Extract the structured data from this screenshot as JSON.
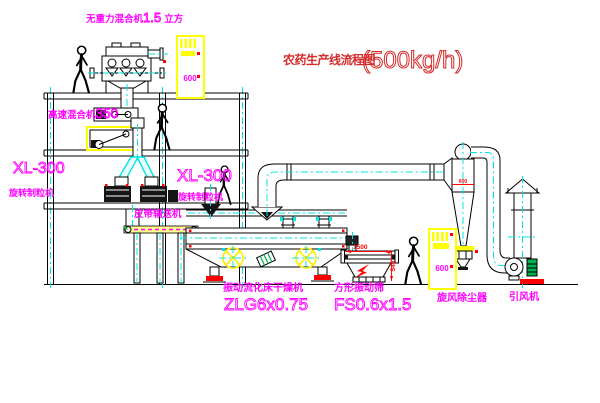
{
  "title": {
    "main": "农药生产线流程图",
    "capacity": "(500kg/h)"
  },
  "labels": {
    "weightless_mixer": {
      "name": "无重力混合机",
      "capacity": "1.5",
      "unit": "立方"
    },
    "high_speed_mixer": {
      "name": "高速混合机",
      "capacity": "350"
    },
    "granulator_left": {
      "model": "XL-300",
      "name": "旋转制粒机"
    },
    "granulator_right": {
      "model": "XL-300",
      "name": "旋转制粒机"
    },
    "belt_conveyor": {
      "name": "皮带输送机"
    },
    "dryer": {
      "name": "振动流化床干燥机",
      "model": "ZLG6x0.75"
    },
    "screen": {
      "name": "方形振动筛",
      "model": "FS0.6x1.5"
    },
    "cyclone": {
      "name": "旋风除尘器",
      "size": "600"
    },
    "fan": {
      "name": "引风机"
    },
    "cabinet_top": {
      "code": "600"
    },
    "cabinet_right": {
      "code": "600"
    }
  },
  "dimensions": {
    "screen_length": "1500",
    "screen_height": "545"
  },
  "colors": {
    "annotation_magenta": "#ff00ff",
    "title_red": "#d42a2a",
    "centerline_cyan": "#00e5e5",
    "highlight_yellow": "#ffff00",
    "dimension_red": "#ff0000",
    "motor_green": "#00b050"
  }
}
